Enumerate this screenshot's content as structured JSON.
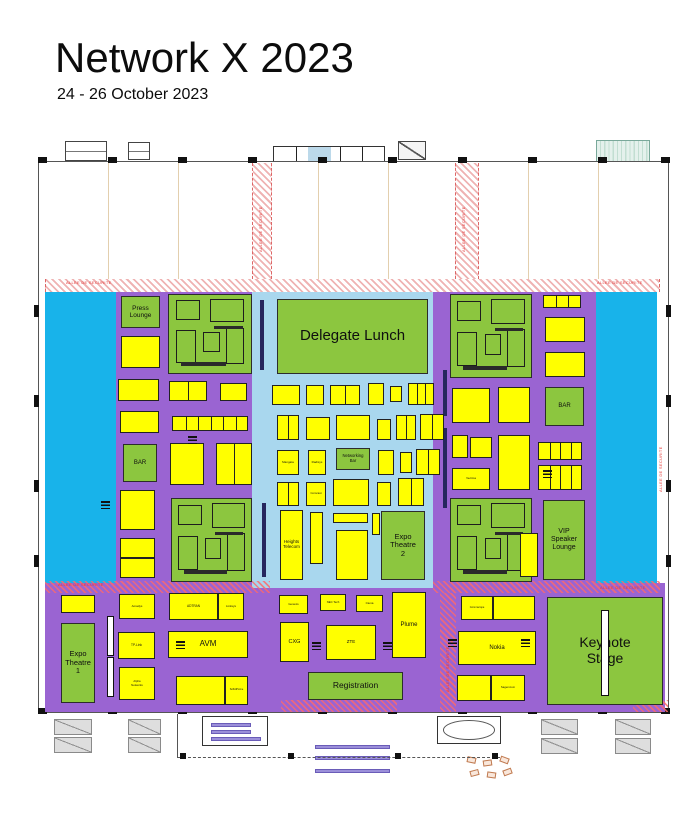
{
  "header": {
    "title": "Network X 2023",
    "dates": "24 - 26 October 2023"
  },
  "plan": {
    "security_text": "ALLEE DE SECURITE",
    "colors": {
      "floor_purple": "#9a64d2",
      "open_cyan": "#18b3ea",
      "central_lightblue": "#a9d7ee",
      "zone_green": "#8cc63f",
      "booth_yellow": "#ffff00",
      "security_red": "#e23a3a"
    },
    "purple": [
      [
        45,
        292,
        612,
        291
      ],
      [
        45,
        583,
        620,
        129
      ]
    ],
    "cyan": [
      [
        45,
        292,
        71,
        291
      ],
      [
        596,
        292,
        61,
        291
      ]
    ],
    "lightblue": [
      252,
      292,
      181,
      296
    ],
    "corridors_white": [
      [
        252,
        163,
        20,
        116
      ],
      [
        455,
        163,
        24,
        116
      ],
      [
        45,
        279,
        615,
        13
      ]
    ],
    "corridors_tint": [
      [
        45,
        581,
        225,
        12
      ],
      [
        433,
        581,
        227,
        12
      ],
      [
        440,
        593,
        16,
        119
      ],
      [
        281,
        700,
        116,
        12
      ],
      [
        633,
        700,
        35,
        12
      ]
    ],
    "security_labels": [
      {
        "x": 66,
        "y": 280,
        "rot": 0
      },
      {
        "x": 597,
        "y": 280,
        "rot": 0
      },
      {
        "x": 58,
        "y": 582,
        "rot": 0
      },
      {
        "x": 600,
        "y": 585,
        "rot": 0
      },
      {
        "x": 258,
        "y": 252,
        "rot": -90
      },
      {
        "x": 461,
        "y": 252,
        "rot": -90
      },
      {
        "x": 445,
        "y": 692,
        "rot": -90
      },
      {
        "x": 658,
        "y": 492,
        "rot": -90
      }
    ],
    "green_zones": [
      {
        "id": "press-lounge",
        "t": "Press\nLounge",
        "fs": 6.5,
        "r": [
          121,
          296,
          39,
          32
        ]
      },
      {
        "id": "lounge-area-top-left",
        "r": [
          168,
          294,
          84,
          80
        ],
        "furn": true
      },
      {
        "id": "lounge-area-top-right",
        "r": [
          450,
          294,
          82,
          84
        ],
        "furn": true
      },
      {
        "id": "delegate-lunch",
        "t": "Delegate Lunch",
        "fs": 15,
        "r": [
          277,
          299,
          151,
          75
        ]
      },
      {
        "id": "networking-bar",
        "t": "Networking\nBar",
        "fs": 4.2,
        "r": [
          336,
          448,
          34,
          22
        ]
      },
      {
        "id": "expo-theatre-2",
        "t": "Expo\nTheatre\n2",
        "fs": 7.5,
        "r": [
          381,
          511,
          44,
          69
        ]
      },
      {
        "id": "vip-speaker-lounge",
        "t": "VIP\nSpeaker\nLounge",
        "fs": 7,
        "r": [
          543,
          500,
          42,
          80
        ]
      },
      {
        "id": "bar-left",
        "t": "BAR",
        "fs": 6,
        "r": [
          123,
          444,
          34,
          38
        ]
      },
      {
        "id": "bar-right",
        "t": "BAR",
        "fs": 6,
        "r": [
          545,
          387,
          39,
          39
        ]
      },
      {
        "id": "lounge-area-bottom-left",
        "r": [
          171,
          498,
          81,
          84
        ],
        "furn": true
      },
      {
        "id": "lounge-area-bottom-right",
        "r": [
          450,
          498,
          82,
          84
        ],
        "furn": true
      },
      {
        "id": "expo-theatre-1",
        "t": "Expo\nTheatre\n1",
        "fs": 7.5,
        "r": [
          61,
          623,
          34,
          80
        ]
      },
      {
        "id": "keynote-stage",
        "t": "Keynote\nStage",
        "fs": 14,
        "r": [
          547,
          597,
          116,
          108
        ]
      },
      {
        "id": "registration",
        "t": "Registration",
        "fs": 8.5,
        "r": [
          308,
          672,
          95,
          28
        ]
      }
    ],
    "furniture_layout": [
      [
        0.08,
        0.07,
        0.3,
        0.25
      ],
      [
        0.5,
        0.05,
        0.42,
        0.3
      ],
      [
        0.08,
        0.45,
        0.25,
        0.42
      ],
      [
        0.42,
        0.48,
        0.2,
        0.25
      ],
      [
        0.7,
        0.42,
        0.22,
        0.46
      ]
    ],
    "furniture_bars": [
      [
        0.15,
        0.86,
        0.55,
        0.05
      ],
      [
        0.55,
        0.4,
        0.35,
        0.04
      ]
    ],
    "booths": [
      {
        "r": [
          121,
          336,
          39,
          32
        ]
      },
      {
        "r": [
          118,
          379,
          41,
          22
        ]
      },
      {
        "r": [
          169,
          381,
          38,
          20
        ],
        "d": [
          0.5
        ]
      },
      {
        "r": [
          220,
          383,
          27,
          18
        ]
      },
      {
        "r": [
          120,
          411,
          39,
          22
        ]
      },
      {
        "r": [
          172,
          416,
          76,
          15
        ],
        "d": [
          0.17,
          0.34,
          0.51,
          0.68,
          0.85
        ]
      },
      {
        "r": [
          170,
          443,
          34,
          42
        ]
      },
      {
        "r": [
          216,
          443,
          36,
          42
        ],
        "d": [
          0.5
        ]
      },
      {
        "r": [
          120,
          490,
          35,
          40
        ]
      },
      {
        "r": [
          120,
          538,
          35,
          20
        ]
      },
      {
        "r": [
          120,
          558,
          35,
          20
        ]
      },
      {
        "r": [
          272,
          385,
          28,
          20
        ]
      },
      {
        "r": [
          306,
          385,
          18,
          20
        ]
      },
      {
        "r": [
          330,
          385,
          30,
          20
        ],
        "d": [
          0.5
        ]
      },
      {
        "r": [
          368,
          383,
          16,
          22
        ]
      },
      {
        "r": [
          390,
          386,
          12,
          16
        ]
      },
      {
        "r": [
          408,
          383,
          26,
          22
        ],
        "d": [
          0.33,
          0.66
        ]
      },
      {
        "r": [
          277,
          415,
          22,
          25
        ],
        "d": [
          0.5
        ]
      },
      {
        "r": [
          306,
          417,
          24,
          23
        ]
      },
      {
        "r": [
          336,
          415,
          34,
          25
        ]
      },
      {
        "r": [
          377,
          419,
          14,
          21
        ]
      },
      {
        "r": [
          396,
          415,
          20,
          25
        ],
        "d": [
          0.5
        ]
      },
      {
        "r": [
          420,
          414,
          24,
          26
        ],
        "d": [
          0.5
        ]
      },
      {
        "r": [
          277,
          450,
          22,
          25
        ],
        "t": "Mangata",
        "fs": 3
      },
      {
        "r": [
          308,
          450,
          18,
          25
        ],
        "t": "Radisys",
        "fs": 3
      },
      {
        "r": [
          378,
          450,
          16,
          25
        ]
      },
      {
        "r": [
          400,
          452,
          12,
          21
        ]
      },
      {
        "r": [
          416,
          449,
          24,
          26
        ],
        "d": [
          0.5
        ]
      },
      {
        "r": [
          277,
          482,
          22,
          24
        ],
        "d": [
          0.5
        ]
      },
      {
        "r": [
          306,
          482,
          20,
          24
        ],
        "t": "Comcast",
        "fs": 2.8
      },
      {
        "r": [
          333,
          479,
          36,
          27
        ]
      },
      {
        "r": [
          377,
          482,
          14,
          24
        ]
      },
      {
        "r": [
          398,
          478,
          26,
          28
        ],
        "d": [
          0.5
        ]
      },
      {
        "r": [
          280,
          510,
          23,
          70
        ],
        "t": "Heights\nTelecom",
        "fs": 4.5
      },
      {
        "r": [
          310,
          512,
          13,
          52
        ]
      },
      {
        "r": [
          333,
          513,
          35,
          10
        ]
      },
      {
        "r": [
          336,
          530,
          32,
          50
        ]
      },
      {
        "r": [
          372,
          513,
          8,
          22
        ]
      },
      {
        "r": [
          452,
          388,
          38,
          35
        ]
      },
      {
        "r": [
          498,
          387,
          32,
          36
        ]
      },
      {
        "r": [
          452,
          435,
          16,
          23
        ]
      },
      {
        "r": [
          470,
          437,
          22,
          21
        ]
      },
      {
        "r": [
          498,
          435,
          32,
          55
        ]
      },
      {
        "r": [
          452,
          468,
          38,
          22
        ],
        "t": "Vecima",
        "fs": 3
      },
      {
        "r": [
          543,
          295,
          38,
          13
        ],
        "d": [
          0.33,
          0.66
        ]
      },
      {
        "r": [
          545,
          317,
          40,
          25
        ]
      },
      {
        "r": [
          545,
          352,
          40,
          25
        ]
      },
      {
        "r": [
          538,
          442,
          44,
          18
        ],
        "d": [
          0.25,
          0.5,
          0.75
        ]
      },
      {
        "r": [
          538,
          465,
          44,
          25
        ],
        "d": [
          0.25,
          0.5,
          0.75
        ]
      },
      {
        "r": [
          520,
          533,
          18,
          44
        ]
      },
      {
        "r": [
          61,
          595,
          34,
          18
        ]
      },
      {
        "r": [
          119,
          594,
          36,
          25
        ],
        "t": "Amadys",
        "fs": 3
      },
      {
        "r": [
          169,
          593,
          49,
          27
        ],
        "t": "ADTRAN",
        "fs": 3.2
      },
      {
        "r": [
          218,
          593,
          26,
          27
        ],
        "t": "Linksys",
        "fs": 3
      },
      {
        "r": [
          118,
          632,
          37,
          27
        ],
        "t": "TP-Link",
        "fs": 3.2
      },
      {
        "r": [
          168,
          631,
          80,
          27
        ],
        "t": "AVM",
        "fs": 8
      },
      {
        "r": [
          119,
          667,
          36,
          33
        ],
        "t": "Alpha\nNetworks",
        "fs": 2.8
      },
      {
        "r": [
          176,
          676,
          49,
          29
        ]
      },
      {
        "r": [
          225,
          676,
          23,
          29
        ],
        "t": "SoftAtHome",
        "fs": 2.5
      },
      {
        "r": [
          279,
          595,
          29,
          19
        ],
        "t": "Genexis",
        "fs": 2.8
      },
      {
        "r": [
          320,
          594,
          26,
          17
        ],
        "t": "NEC Tech",
        "fs": 2.8
      },
      {
        "r": [
          356,
          595,
          27,
          17
        ],
        "t": "Ciena",
        "fs": 3
      },
      {
        "r": [
          392,
          592,
          34,
          66
        ],
        "t": "Plume",
        "fs": 6
      },
      {
        "r": [
          280,
          622,
          29,
          40
        ],
        "t": "CXG",
        "fs": 5.5
      },
      {
        "r": [
          326,
          625,
          50,
          35
        ],
        "t": "ZTE",
        "fs": 4.5
      },
      {
        "r": [
          461,
          596,
          32,
          24
        ],
        "t": "Commscope",
        "fs": 2.6
      },
      {
        "r": [
          493,
          596,
          42,
          24
        ]
      },
      {
        "r": [
          458,
          631,
          78,
          34
        ],
        "t": "Nokia",
        "fs": 6
      },
      {
        "r": [
          457,
          675,
          34,
          26
        ]
      },
      {
        "r": [
          491,
          675,
          34,
          26
        ],
        "t": "Sagemcom",
        "fs": 2.8
      }
    ],
    "doors": [
      [
        188,
        436
      ],
      [
        101,
        501
      ],
      [
        176,
        641
      ],
      [
        312,
        642
      ],
      [
        383,
        642
      ],
      [
        448,
        639
      ],
      [
        521,
        639
      ],
      [
        543,
        470
      ]
    ],
    "dark_bars": [
      [
        260,
        300,
        4,
        70
      ],
      [
        262,
        503,
        4,
        74
      ],
      [
        443,
        370,
        4,
        46
      ],
      [
        443,
        428,
        4,
        80
      ]
    ],
    "white_bars": [
      [
        107,
        616,
        7,
        40
      ],
      [
        107,
        657,
        7,
        40
      ],
      [
        601,
        610,
        8,
        86
      ]
    ],
    "walls": [
      [
        38,
        161,
        631,
        1
      ],
      [
        38,
        712,
        631,
        1
      ],
      [
        38,
        161,
        1,
        552
      ],
      [
        668,
        161,
        1,
        552
      ]
    ],
    "column_xs": [
      38,
      108,
      178,
      248,
      318,
      388,
      458,
      528,
      598,
      661
    ],
    "grid_xs": [
      108,
      178,
      318,
      388,
      528,
      598
    ],
    "wall_ticks": [
      [
        34,
        305
      ],
      [
        34,
        395
      ],
      [
        34,
        480
      ],
      [
        34,
        555
      ],
      [
        666,
        305
      ],
      [
        666,
        395
      ],
      [
        666,
        480
      ],
      [
        666,
        555
      ]
    ],
    "outside_top": [
      {
        "r": [
          65,
          141,
          42,
          20
        ],
        "kind": "dock"
      },
      {
        "r": [
          128,
          142,
          22,
          18
        ],
        "kind": "dock"
      },
      {
        "r": [
          273,
          146,
          112,
          16
        ],
        "kind": "entrance",
        "d": [
          0.2,
          0.4,
          0.6,
          0.8
        ],
        "blue": [
          0.31,
          0.21
        ]
      },
      {
        "r": [
          398,
          141,
          28,
          19
        ],
        "kind": "diag"
      },
      {
        "r": [
          596,
          140,
          54,
          22
        ],
        "kind": "canopy"
      }
    ],
    "outside_bottom": {
      "stairs": [
        [
          54,
          719,
          38,
          16
        ],
        [
          54,
          737,
          38,
          16
        ],
        [
          128,
          719,
          33,
          16
        ],
        [
          128,
          737,
          33,
          16
        ],
        [
          541,
          719,
          37,
          16
        ],
        [
          541,
          738,
          37,
          16
        ],
        [
          615,
          719,
          36,
          16
        ],
        [
          615,
          738,
          36,
          16
        ]
      ],
      "center_block": [
        202,
        716,
        66,
        30
      ],
      "oval_block": [
        437,
        716,
        64,
        28
      ],
      "travelators": [
        [
          315,
          745,
          75,
          4
        ],
        [
          315,
          756,
          75,
          4
        ],
        [
          315,
          769,
          75,
          4
        ]
      ],
      "marks": [
        [
          467,
          757,
          12
        ],
        [
          483,
          760,
          -8
        ],
        [
          500,
          757,
          20
        ],
        [
          470,
          770,
          -15
        ],
        [
          487,
          772,
          8
        ],
        [
          503,
          769,
          -20
        ]
      ],
      "dashline": [
        178,
        757,
        322,
        1
      ],
      "posts": [
        [
          180,
          753
        ],
        [
          288,
          753
        ],
        [
          395,
          753
        ],
        [
          492,
          753
        ]
      ],
      "vline": [
        177,
        714,
        1,
        44
      ]
    }
  }
}
